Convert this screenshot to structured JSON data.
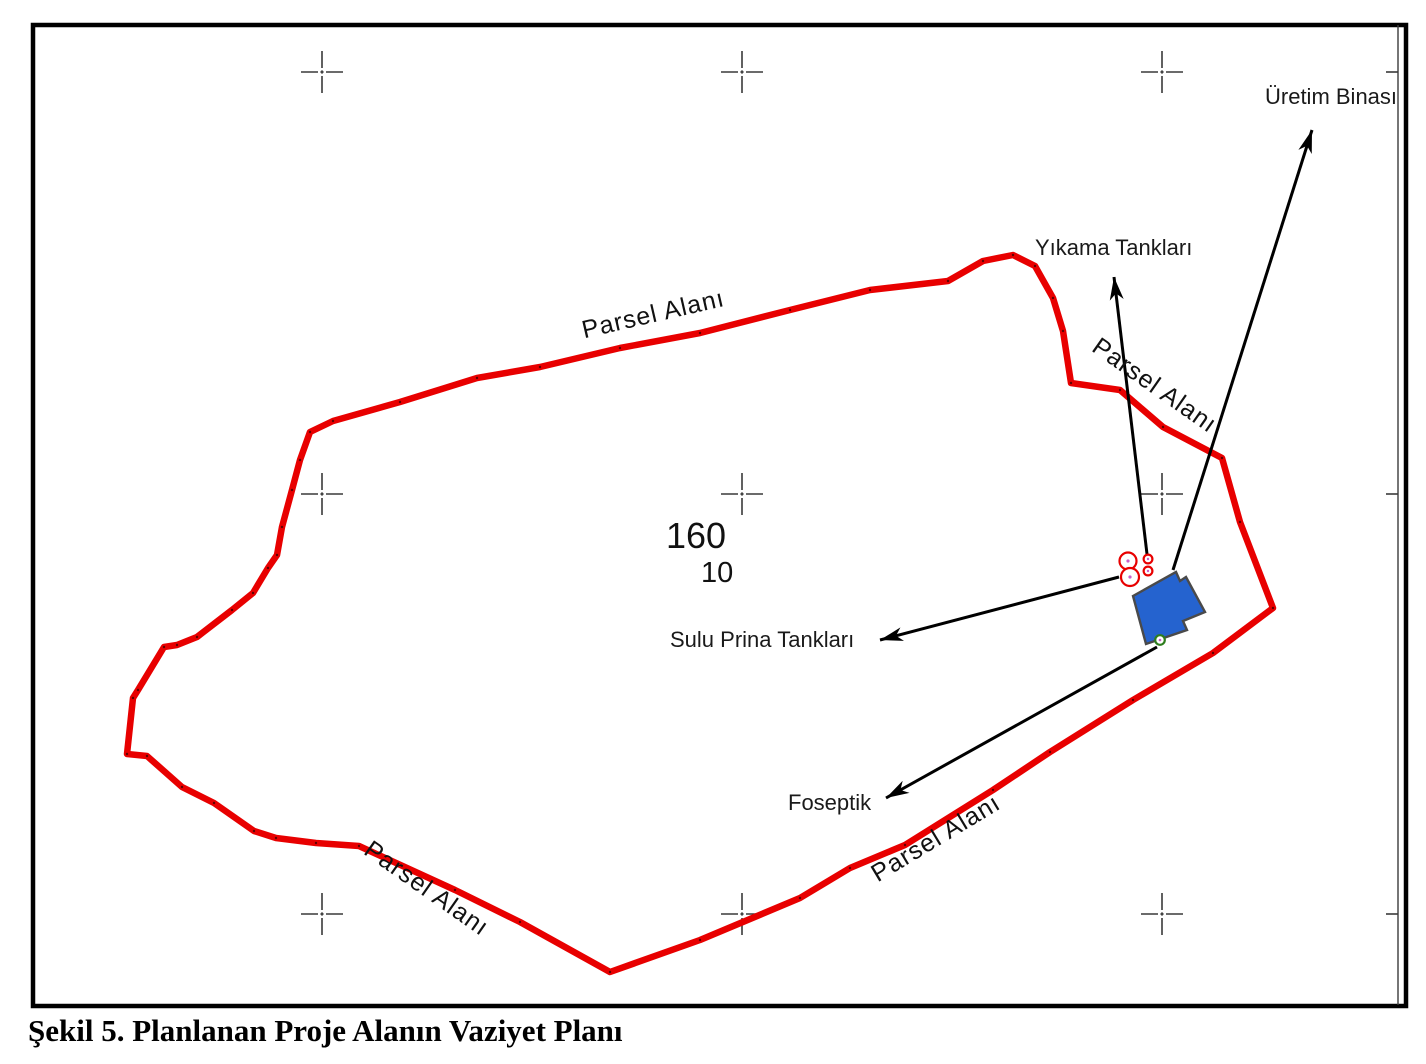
{
  "figure": {
    "caption": "Şekil 5. Planlanan Proje Alanın Vaziyet Planı"
  },
  "plan": {
    "parsel_labels": [
      "Parsel Alanı",
      "Parsel Alanı",
      "Parsel Alanı",
      "Parsel Alanı"
    ],
    "feature_labels": {
      "production_building": "Üretim Binası",
      "washing_tanks": "Yıkama Tankları",
      "wet_pomace_tanks": "Sulu Prina Tankları",
      "septic_tank": "Foseptik"
    },
    "parcel_block_number": "160",
    "parcel_number": "10",
    "colors": {
      "boundary": "#e80000",
      "building_fill": "#2563cf",
      "building_stroke": "#4a4a4a",
      "tank_ring": "#e80000",
      "septic_ring": "#2e7d1e",
      "center_dot": "#c95fc9",
      "leader": "#000000",
      "cross": "#3a3a3a"
    }
  }
}
